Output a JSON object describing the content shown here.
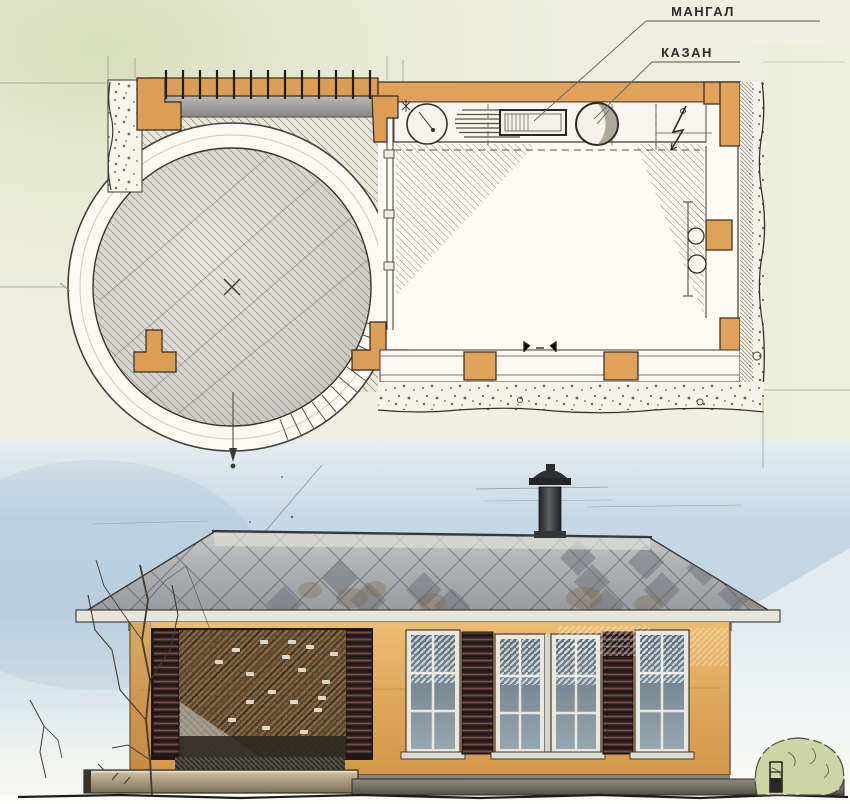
{
  "annotations": {
    "mangal": {
      "label": "МАНГАЛ"
    },
    "kazan": {
      "label": "КАЗАН"
    }
  },
  "palette": {
    "plan_wall_orange": "#dfa258",
    "elevation_wall_orange": "#e0a75c",
    "roof_gray": "#a6a8a9",
    "roof_diamond_dark": "#6c7177",
    "sky_blue": "#c6d8e6",
    "wash_green": "#e4e8d0",
    "shutter_brown": "#2d1e1f",
    "door_wood_brown": "#63492c",
    "window_glass_blue": "#7c8d98",
    "bush_green": "#cdd4a6",
    "ink": "#3a3a36",
    "paper": "#f0f0e2"
  }
}
